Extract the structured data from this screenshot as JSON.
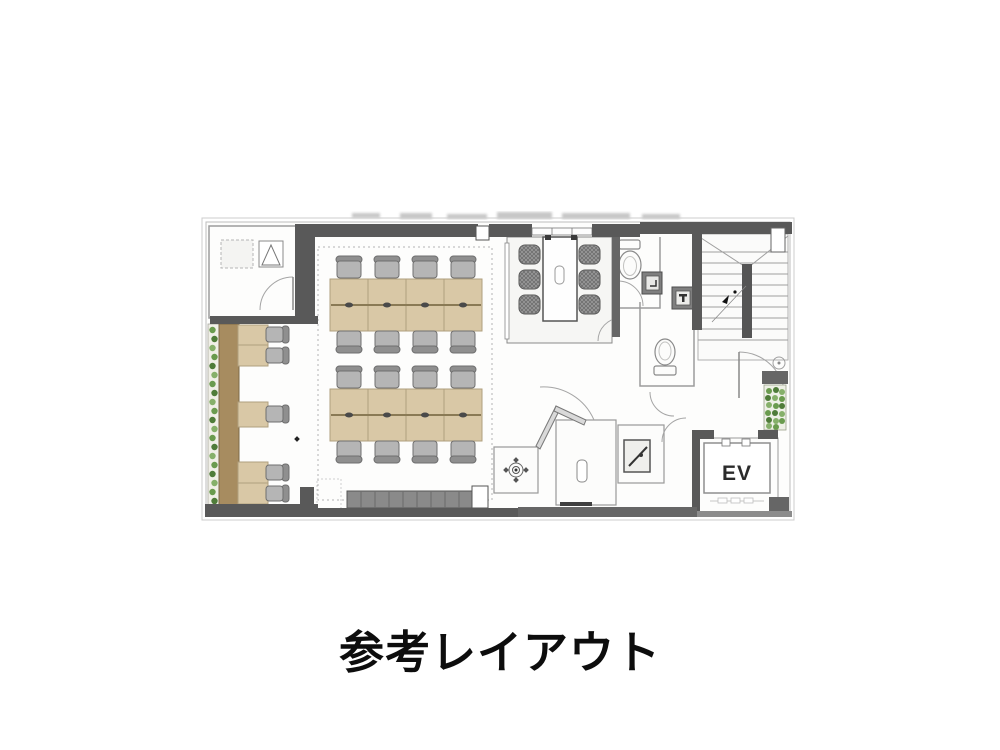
{
  "caption": "参考レイアウト",
  "floorplan": {
    "ev_label": "EV",
    "counts": {
      "desk_islands": 2,
      "seats_per_island": 8,
      "counter_seats": 5,
      "meeting_room_seats": 6,
      "toilets": 2,
      "elevators": 1,
      "stairwells": 1
    },
    "colors": {
      "wall": "#595959",
      "floor": "#fdfdfc",
      "desk": "#d9c8a6",
      "desk_edge": "#b09f7e",
      "desk_centerline": "#8a7a55",
      "chair": "#b5b5b5",
      "chair_back": "#8f8f8f",
      "chair_edge": "#6f6f6f",
      "meeting_chair": "#9a9a9a",
      "counter_wood": "#a78c60",
      "bench": "#8a8a8a",
      "plant_green": "#6a9b4e",
      "plant_green_dark": "#4f7c39",
      "plant_green_light": "#86b06a",
      "caption_color": "#0d0d0d"
    },
    "features": [
      "entrance-room",
      "office-area",
      "desk-island-1",
      "desk-island-2",
      "counter-seating",
      "planter-strip-left",
      "planter-strip-right",
      "meeting-room",
      "toilet-upper",
      "toilet-lower",
      "washbasin",
      "stairwell",
      "elevator",
      "bench-lockers",
      "pantry-room",
      "utility-room"
    ]
  }
}
